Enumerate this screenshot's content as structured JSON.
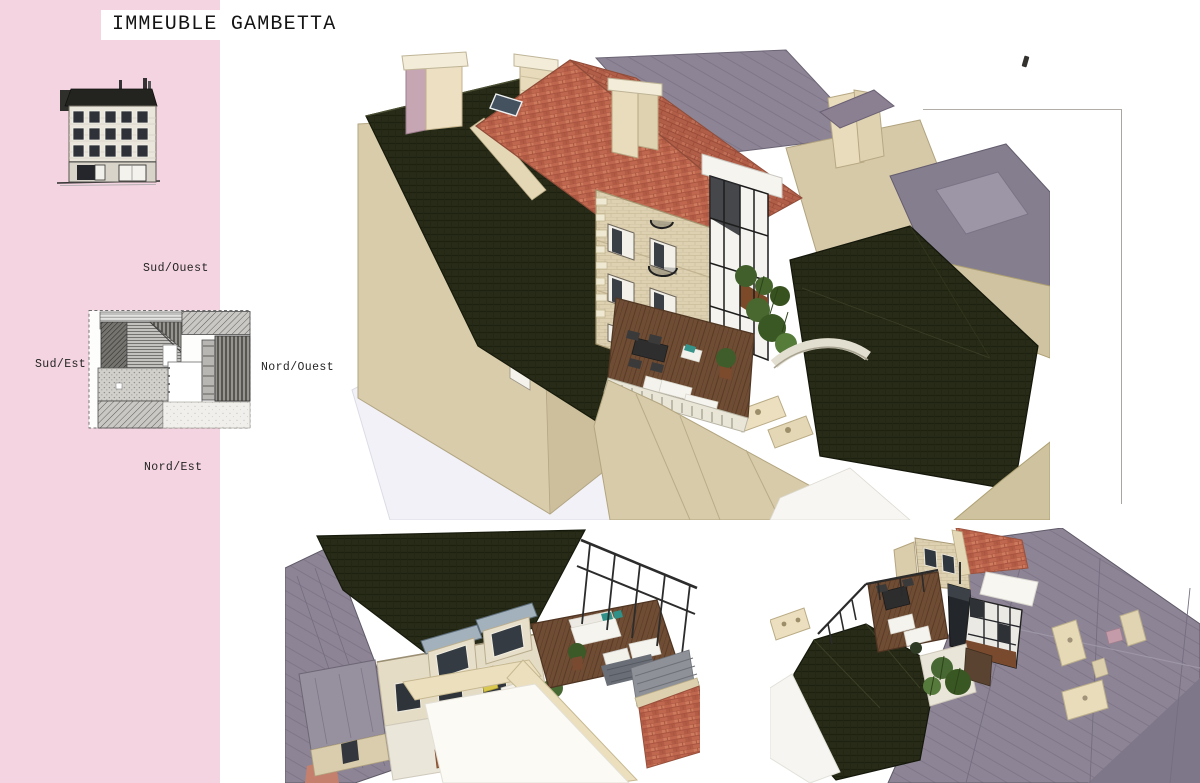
{
  "page": {
    "title": "IMMEUBLE GAMBETTA"
  },
  "orientation_labels": {
    "top": "Sud/Ouest",
    "left": "Sud/Est",
    "right": "Nord/Ouest",
    "bottom": "Nord/Est"
  },
  "figures": {
    "elevation": "street-facade-elevation",
    "roof_plan": "roof-plan-with-orientations",
    "main_view": "aerial-3d-view-of-terrace",
    "bottom_left_view": "aerial-3d-view-of-courtyard",
    "bottom_right_view": "aerial-3d-view-rear"
  },
  "colors": {
    "sidebar_pink": "#f3d4e0",
    "dark_roof": "#272b17",
    "red_tile": "#c0684f",
    "slate_purple": "#8d8595",
    "stone_beige": "#d9ccab",
    "cream": "#ecdfc0",
    "deck_wood": "#6f4c34",
    "foliage_green": "#476832",
    "ink": "#1c1c1c"
  }
}
